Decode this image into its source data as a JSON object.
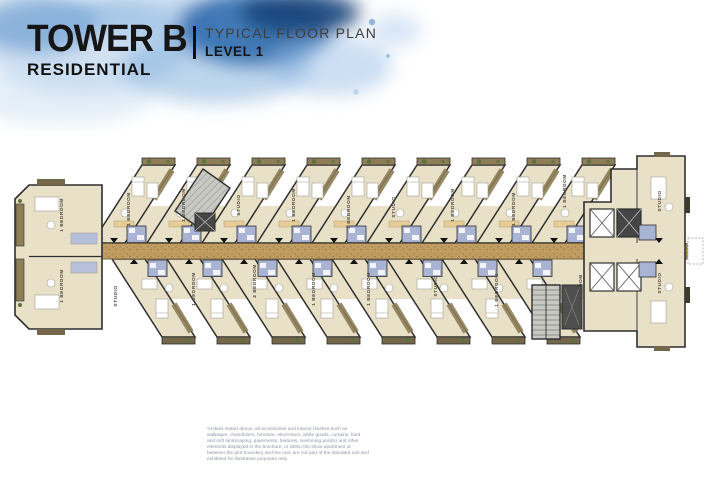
{
  "header": {
    "title": "TOWER B",
    "subtitle": "RESIDENTIAL",
    "plan_type": "TYPICAL FLOOR PLAN",
    "level": "LEVEL 1"
  },
  "plan": {
    "unit_labels_top": [
      "1 BEDROOM",
      "1 BEDROOM",
      "1 BEDROOM",
      "STUDIO",
      "1 BEDROOM",
      "1 BEDROOM",
      "STUDIO",
      "1 BEDROOM",
      "1 BEDROOM",
      "1 BEDROOM",
      "STUDIO"
    ],
    "unit_labels_bottom": [
      "1 BEDROOM",
      "STUDIO",
      "1 BEDROOM",
      "2 BEDROOM",
      "1 BEDROOM",
      "1 BEDROOM",
      "STUDIO",
      "1 BEDROOM",
      "1 BEDROOM",
      "STUDIO"
    ],
    "colors": {
      "floor": "#e9e0c8",
      "corridor": "#c09d62",
      "bathroom": "#a9b3d3",
      "walls": "#2e2e2e",
      "balcony": "#8d7e57",
      "splash_blue": "#1d5ea6"
    }
  },
  "footnote": {
    "text": "*Unless stated above, all accessories and interior finishes such as wallpaper, chandeliers, furniture, electronics, white goods, curtains, hard and soft landscaping, pavements, features, swimming pool(s) and other elements displayed in the brochure, or within the show apartment or between the plot boundary and the unit, are not part of the standard unit and exhibited for illustrative purposes only."
  }
}
